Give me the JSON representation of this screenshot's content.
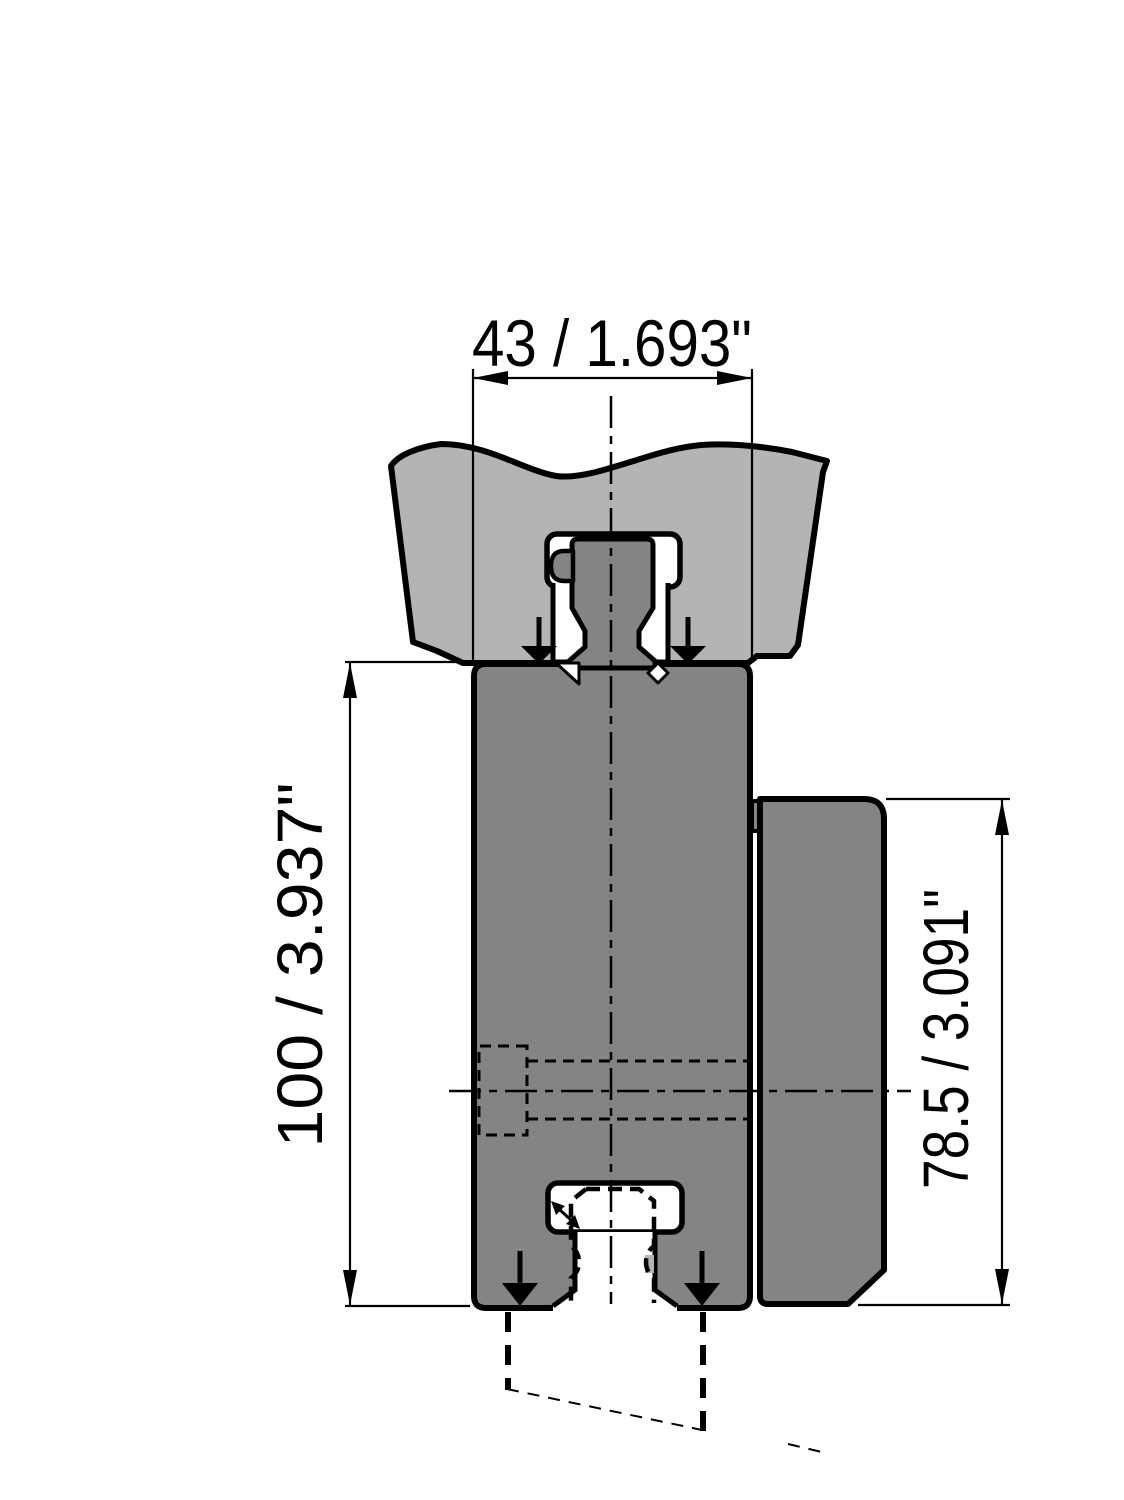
{
  "drawing": {
    "type": "technical-drawing",
    "description": "Cross-section of a press-brake tool adapter clamped in an upper beam, with phantom lower tool",
    "parts": {
      "upper_beam": "press-brake upper beam clamp",
      "adapter_body": "tool adapter body",
      "side_block": "rear support block",
      "upper_tang": "clamped tool tang with safety click",
      "lower_slot": "lower tool clamping slot",
      "phantom_tool": "lower tool shown dashed"
    },
    "dimensions": {
      "width": {
        "label": "43 / 1.693\"",
        "mm": "43",
        "inches": "1.693"
      },
      "total_height": {
        "label": "100 / 3.937\"",
        "mm": "100",
        "inches": "3.937"
      },
      "side_height": {
        "label": "78.5 / 3.091\"",
        "mm": "78.5",
        "inches": "3.091"
      }
    },
    "colors": {
      "beam_gray": "#b4b4b4",
      "body_gray": "#848484",
      "outline": "#000000",
      "background": "#ffffff"
    }
  }
}
